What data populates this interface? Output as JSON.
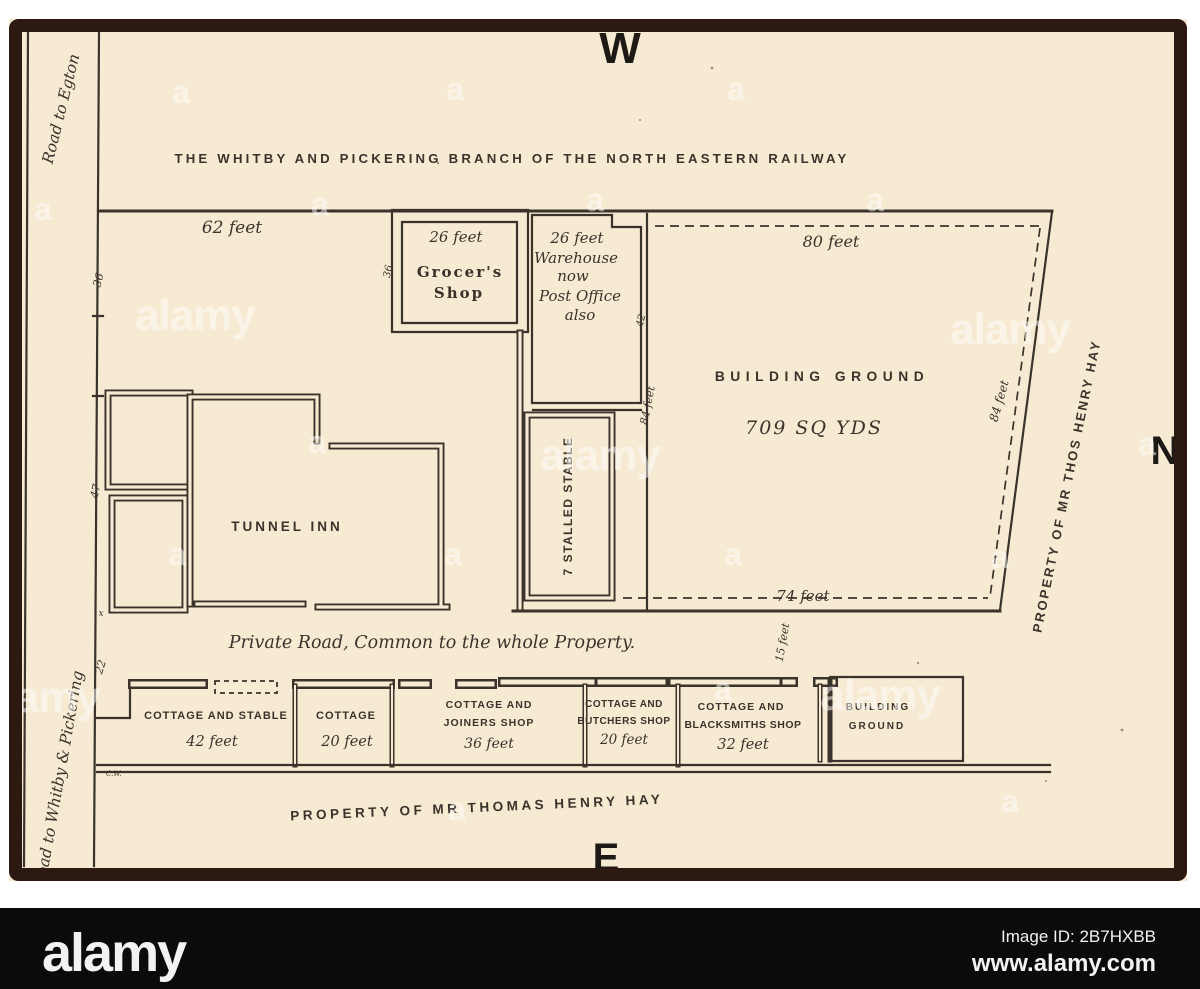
{
  "compass": {
    "west": "W",
    "north": "N",
    "east": "E"
  },
  "railway_title": "THE WHITBY AND PICKERING BRANCH OF THE NORTH EASTERN RAILWAY",
  "roads": {
    "egton": "Road to Egton",
    "whitby": "Road to Whitby & Pickering",
    "private": "Private Road, Common to the whole Property."
  },
  "frontage": {
    "top": "62 feet"
  },
  "boundary_marks": {
    "m36": "36",
    "m47": "47",
    "m22": "22",
    "x": "x",
    "cw": "C.W."
  },
  "grocer": {
    "dim": "26 feet",
    "line1": "Grocer's",
    "line2": "Shop",
    "side": "36"
  },
  "warehouse": {
    "dim": "26 feet",
    "line1": "Warehouse",
    "line2": "now",
    "line3": "Post Office",
    "line4": "also",
    "side": "42"
  },
  "stable": {
    "label": "7 STALLED STABLE",
    "dim": "84 feet"
  },
  "tunnel_inn": {
    "label": "TUNNEL INN"
  },
  "building_ground": {
    "name": "BUILDING GROUND",
    "area": "709 SQ YDS",
    "top": "80 feet",
    "bottom": "74 feet",
    "right": "84 feet",
    "offset": "15 feet"
  },
  "cottages": [
    {
      "line1": "COTTAGE AND STABLE",
      "line2": "42 feet"
    },
    {
      "line1": "COTTAGE",
      "line2": "20 feet"
    },
    {
      "line1": "COTTAGE AND",
      "line2": "JOINERS SHOP",
      "line3": "36 feet"
    },
    {
      "line1": "COTTAGE AND",
      "line2": "BUTCHERS SHOP",
      "line3": "20 feet"
    },
    {
      "line1": "COTTAGE AND",
      "line2": "BLACKSMITHS SHOP",
      "line3": "32 feet"
    },
    {
      "line1": "BUILDING",
      "line2": "GROUND"
    }
  ],
  "ownership": {
    "south": "PROPERTY OF MR THOMAS HENRY HAY",
    "east": "PROPERTY OF MR THOS HENRY HAY"
  },
  "watermark": {
    "letter": "a",
    "logo": "alamy"
  },
  "footer": {
    "logo": "alamy",
    "image_id": "Image ID: 2B7HXBB",
    "url": "www.alamy.com"
  },
  "colors": {
    "paper": "#f6ead2",
    "ink": "#39332b",
    "frame": "#2c1911",
    "bar": "#0b0b0b"
  }
}
